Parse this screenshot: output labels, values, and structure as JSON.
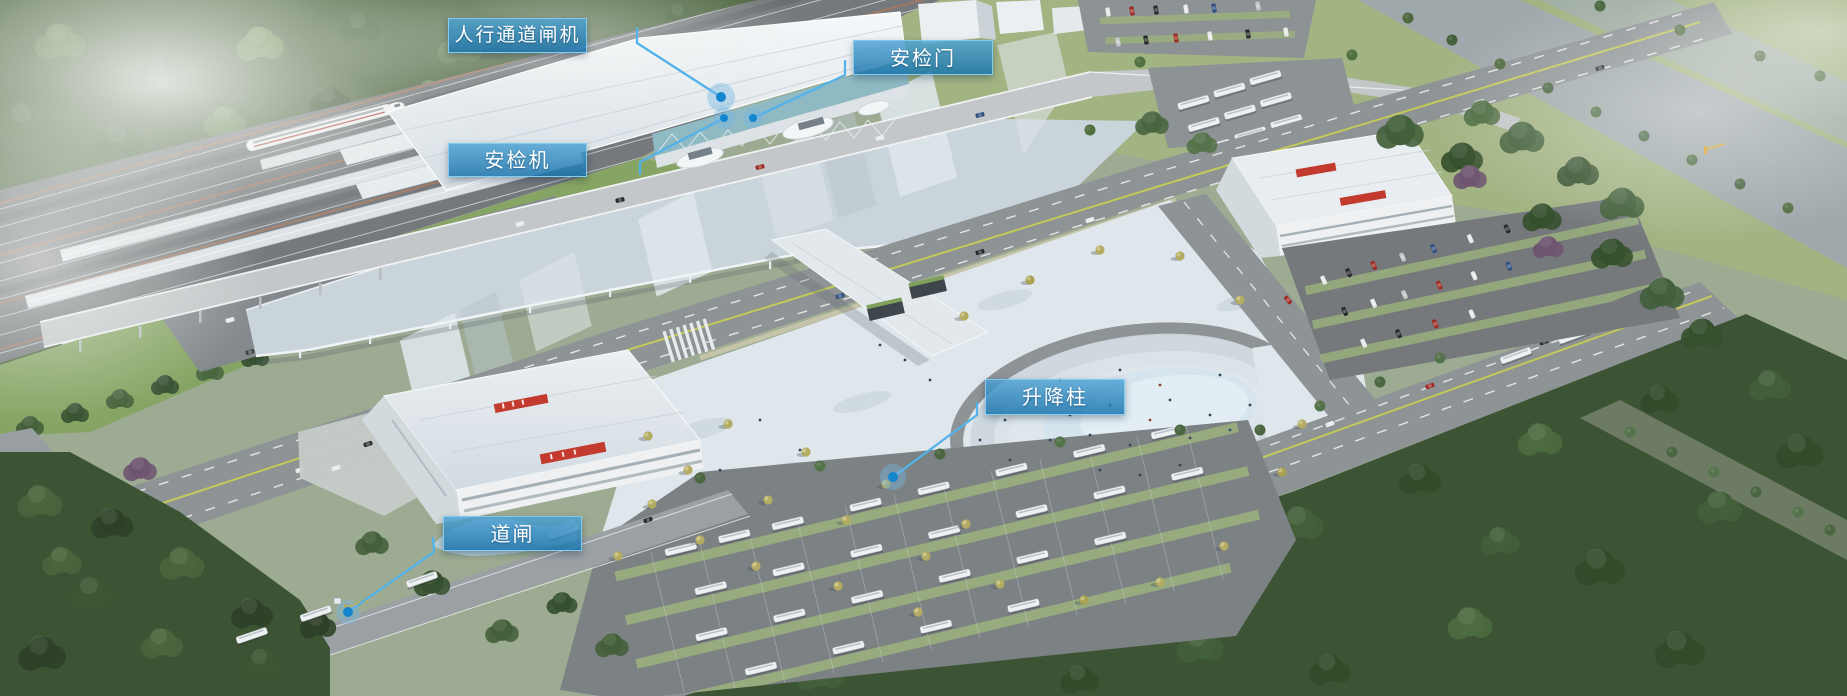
{
  "meta": {
    "title": "车站安防设备分布鸟瞰图",
    "canvas": {
      "width": 1847,
      "height": 696
    },
    "description": "高铁车站园区鸟瞰渲染图：铁路站台与动车组、车站主楼、落客雨棚、站前广场、环形下沉广场、公交枢纽、停车场及道路绿化；图上以蓝色标签标注安防设备位置"
  },
  "scene": {
    "palette": {
      "forest": "#4d653f",
      "forest_dark": "#3c5433",
      "grass": "#86a463",
      "lawn": "#a3b483",
      "water": "#a2adb0",
      "track_bed": "#75797c",
      "rail": "#c9cdd0",
      "platform_canopy": "#dde2e6",
      "platform_edge": "#aa7a5e",
      "train_body": "#f4f6f7",
      "train_stripe": "#b03a2e",
      "station_roof": "#ecf1f4",
      "station_glass": "#8fb9c3",
      "big_canopy": "#cad4db",
      "road": "#8e9396",
      "road_light": "#c3c7c9",
      "lane_yellow": "#c9cf52",
      "lane_white": "#f2f4f4",
      "plaza": "#dfe7ec",
      "plaza_shadow": "#c6d2da",
      "step_tan": "#d9cdb2",
      "oval_inner": "#d6e4ee",
      "asphalt_lot": "#7c8184",
      "green_strip": "#9cb37c",
      "building_white": "#eef0f1",
      "sign_red": "#c23b2e",
      "tree_olive": "#b2ab61"
    }
  },
  "annotations": {
    "line_color": "#54b2ea",
    "dot_color": "#1486cd",
    "halo_color": "rgba(116,180,226,0.42)",
    "labels": [
      {
        "id": "pedestrian-turnstile",
        "text": "人行通道闸机",
        "style": "left:448px;top:18px;width:139px;height:35px;font-size:19px",
        "line_points": "637,28 637,43 721,97",
        "dot_transform": "translate(721,97)",
        "halo_r": "14",
        "core_r": "5"
      },
      {
        "id": "security-gate",
        "text": "安检门",
        "style": "left:853px;top:40px;width:140px;height:35px",
        "line_points": "845,61 845,75 753,118",
        "dot_transform": "translate(753,118)",
        "halo_r": "10",
        "core_r": "4"
      },
      {
        "id": "xray-scanner",
        "text": "安检机",
        "style": "left:448px;top:143px;width:139px;height:34px",
        "line_points": "640,174 640,162 724,118",
        "dot_transform": "translate(724,118)",
        "halo_r": "11",
        "core_r": "4"
      },
      {
        "id": "lifting-bollard",
        "text": "升降柱",
        "style": "left:985px;top:379px;width:140px;height:36px",
        "line_points": "977,403 977,415 893,477",
        "dot_transform": "translate(893,477)",
        "halo_r": "13",
        "core_r": "5"
      },
      {
        "id": "road-barrier",
        "text": "道闸",
        "style": "left:443px;top:516px;width:139px;height:35px",
        "line_points": "433,538 434,552 348,612",
        "dot_transform": "translate(348,612)",
        "halo_r": "12",
        "core_r": "5"
      }
    ]
  }
}
